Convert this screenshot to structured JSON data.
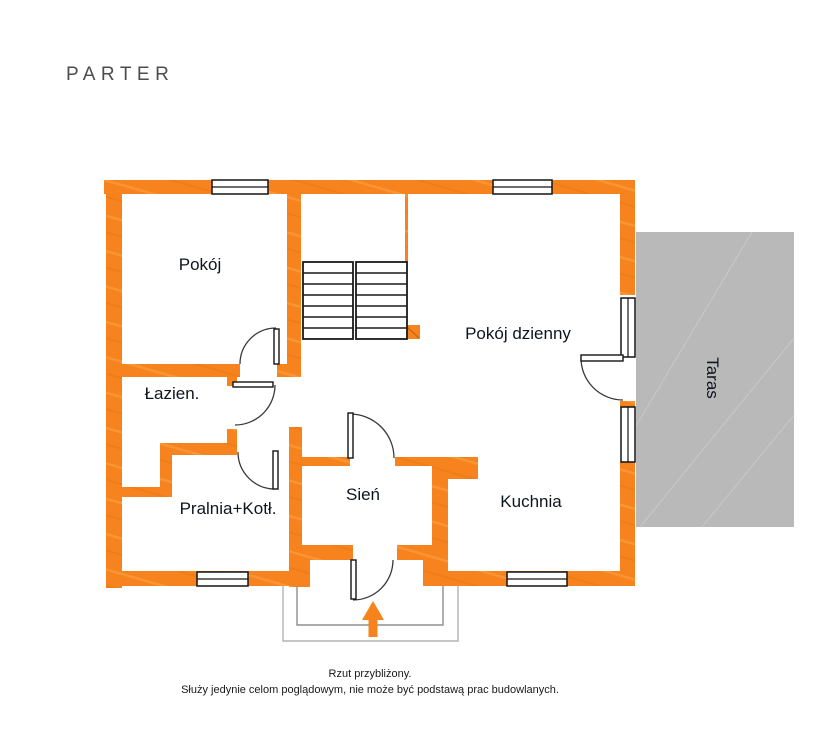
{
  "title": "PARTER",
  "rooms": {
    "pokoj": "Pokój",
    "pokoj_dzienny": "Pokój dzienny",
    "lazienka": "Łazien.",
    "pralnia": "Pralnia+Kotł.",
    "sien": "Sień",
    "kuchnia": "Kuchnia",
    "taras": "Taras"
  },
  "footer": {
    "line1": "Rzut przybliżony.",
    "line2": "Służy jedynie celom poglądowym, nie może być podstawą prac budowlanych."
  },
  "colors": {
    "wall_orange": "#F6831D",
    "wall_streak": "#FB9A3F",
    "terrace_gray": "#B9B9B9",
    "line_black": "#1A1A1A",
    "porch_gray": "#A9A9A9",
    "label_text": "#10141E"
  }
}
